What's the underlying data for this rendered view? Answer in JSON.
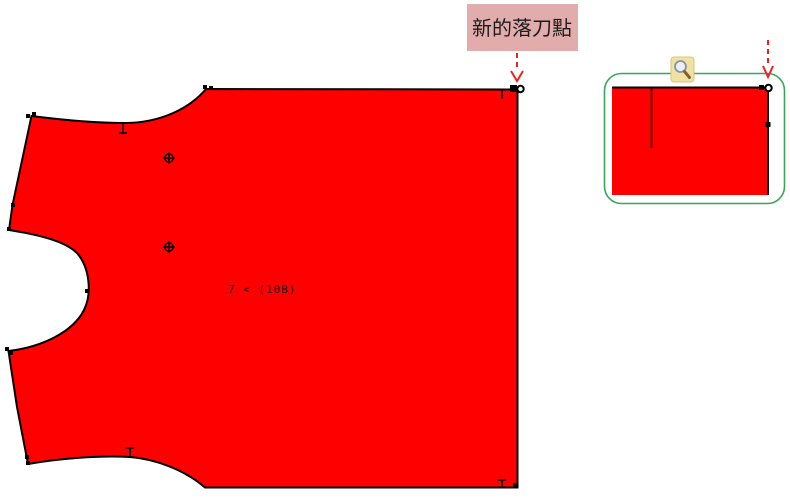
{
  "canvas": {
    "background": "#ffffff",
    "width": 790,
    "height": 499
  },
  "annotation": {
    "label": "新的落刀點",
    "box_color": "#e2acac",
    "text_color": "#1c1c1c",
    "arrow_color": "#ee2222"
  },
  "pattern_piece": {
    "piece_label": "7 < (10B)",
    "fill_color": "#ff0000",
    "outline_color": "#000000",
    "drill_marks": 2,
    "edge_notches": 4
  },
  "zoom_preview": {
    "border_color": "#3aa65c",
    "piece_fill_color": "#ff0000",
    "icon": "magnifier-icon",
    "arrow_color": "#ee2222"
  }
}
